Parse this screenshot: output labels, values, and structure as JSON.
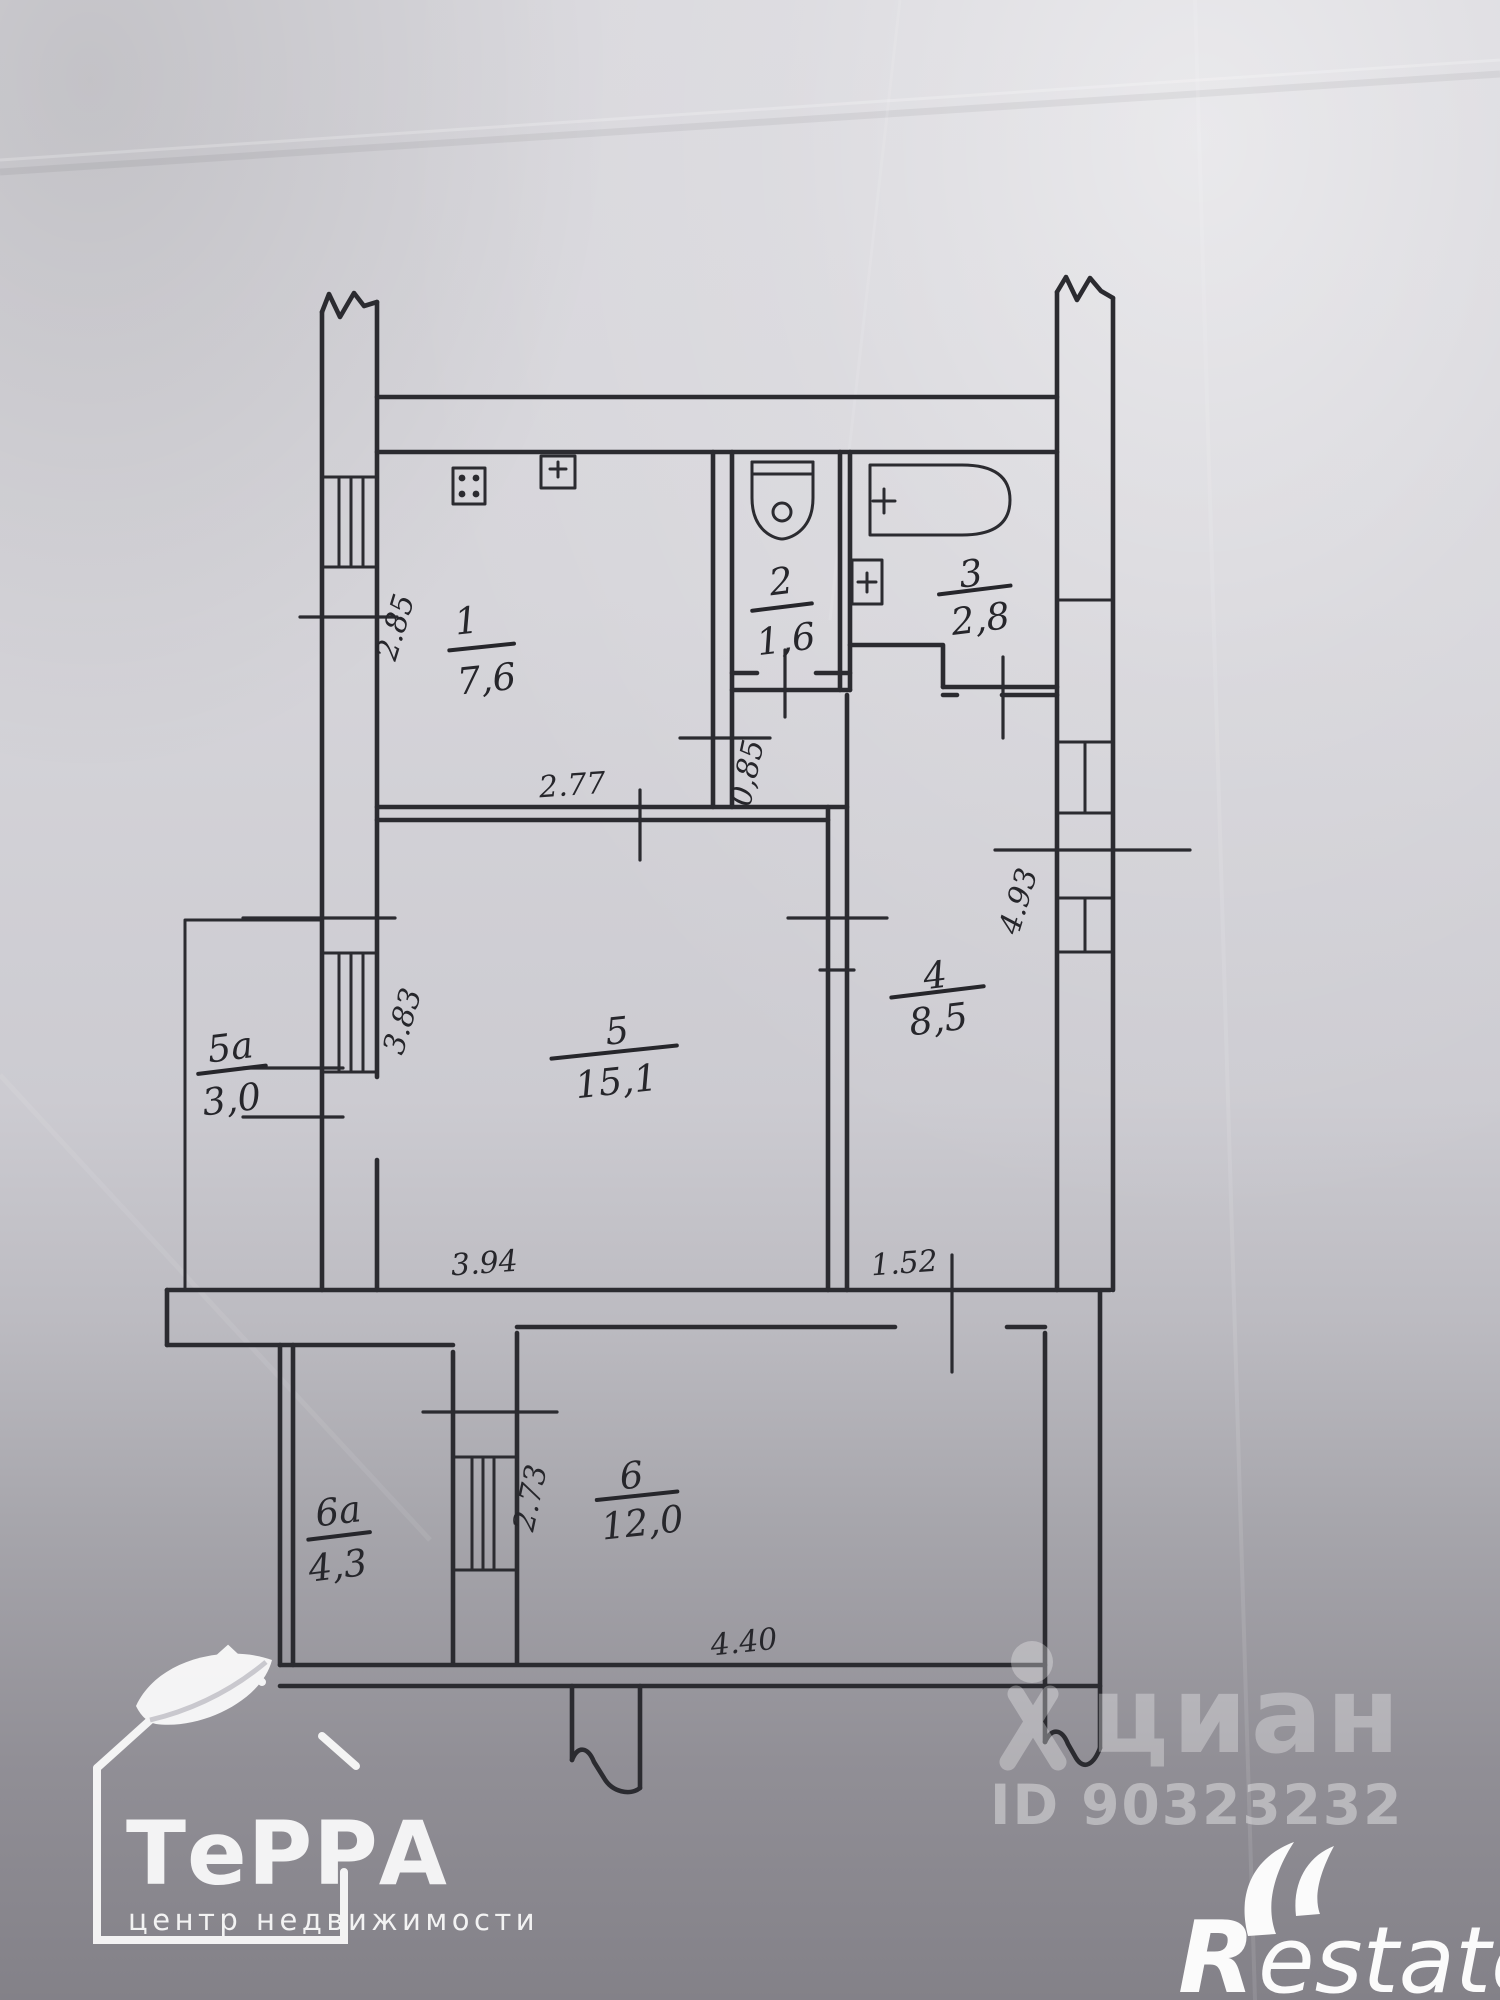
{
  "rooms": [
    {
      "number": "1",
      "area": "7,6"
    },
    {
      "number": "2",
      "area": "1,6"
    },
    {
      "number": "3",
      "area": "2,8"
    },
    {
      "number": "4",
      "area": "8,5"
    },
    {
      "number": "5",
      "area": "15,1"
    },
    {
      "number": "5а",
      "area": "3,0"
    },
    {
      "number": "6",
      "area": "12,0"
    },
    {
      "number": "6а",
      "area": "4,3"
    }
  ],
  "dimensions": {
    "d285": "2.85",
    "d277": "2.77",
    "d085": "0,85",
    "d383": "3.83",
    "d493": "4.93",
    "d394": "3.94",
    "d152": "1.52",
    "d273": "2.73",
    "d440": "4.40"
  },
  "watermarks": {
    "cian_text": "циан",
    "cian_id": "ID 90323232",
    "restate_r": "R",
    "restate_estate": "estate",
    "terra_title": "ТеРРА",
    "terra_subtitle": "центр недвижимости"
  },
  "colors": {
    "ink": "#2b2b30",
    "paper_light": "#dddce1",
    "paper_dark": "#85838a",
    "watermark_white": "#ffffff"
  }
}
